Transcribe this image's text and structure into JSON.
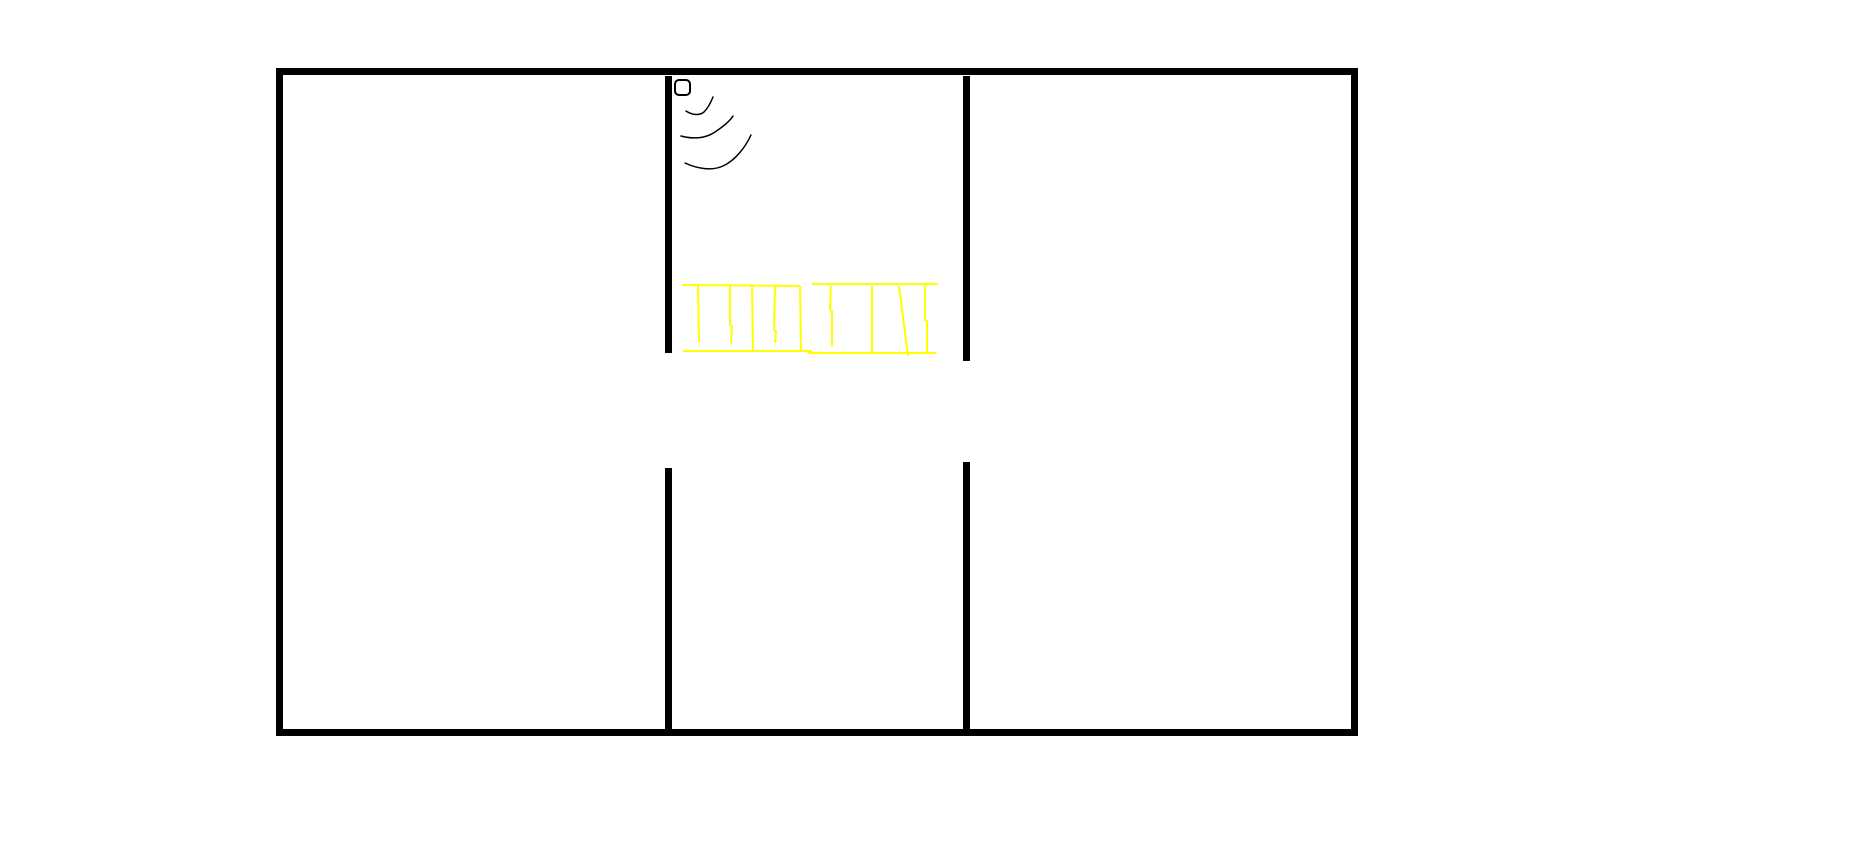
{
  "canvas": {
    "width": 1860,
    "height": 861,
    "background_color": "#ffffff"
  },
  "colors": {
    "wall": "#000000",
    "sketch_line": "#000000",
    "ladder": "#ffff00"
  },
  "floor_plan": {
    "outer_wall": {
      "x": 276,
      "y": 68,
      "width": 1082,
      "height": 668,
      "thickness": 7
    },
    "inner_walls": [
      {
        "name": "left-divider-upper",
        "x": 665,
        "y": 76,
        "width": 7,
        "height": 277
      },
      {
        "name": "left-divider-lower",
        "x": 665,
        "y": 468,
        "width": 7,
        "height": 261
      },
      {
        "name": "right-divider-upper",
        "x": 963,
        "y": 76,
        "width": 7,
        "height": 285
      },
      {
        "name": "right-divider-lower",
        "x": 963,
        "y": 462,
        "width": 7,
        "height": 267
      }
    ],
    "doorway_gaps": [
      {
        "name": "left-divider-doorway",
        "x": 665,
        "y_top": 353,
        "y_bottom": 468
      },
      {
        "name": "right-divider-doorway",
        "x": 963,
        "y_top": 361,
        "y_bottom": 462
      }
    ],
    "rooms": [
      {
        "name": "left-room"
      },
      {
        "name": "middle-room"
      },
      {
        "name": "right-room"
      }
    ]
  },
  "wifi_device": {
    "box": {
      "x": 675,
      "y": 80,
      "width": 15,
      "height": 15,
      "rx": 4,
      "stroke_width": 2
    },
    "waves": [
      {
        "name": "signal-wave-1",
        "path": "M 686 111 C 692 115 699 116 704 112 C 708 108 711 102 713 97"
      },
      {
        "name": "signal-wave-2",
        "path": "M 681 136 C 692 139 705 139 715 132 C 724 126 730 121 733 116"
      },
      {
        "name": "signal-wave-3",
        "path": "M 685 163 C 698 169 712 171 723 166 C 736 160 746 146 751 135"
      }
    ]
  },
  "ladder": {
    "stroke_width": 2,
    "rails": [
      {
        "name": "ladder-top-rail-left",
        "points": "682,285 800,286"
      },
      {
        "name": "ladder-top-rail-right",
        "points": "812,284 938,284"
      },
      {
        "name": "ladder-bottom-rail-left",
        "points": "683,351 812,351"
      },
      {
        "name": "ladder-bottom-rail-right",
        "points": "808,353 936,353"
      }
    ],
    "rungs": [
      {
        "name": "ladder-rung-1",
        "points": "698,286 699,343"
      },
      {
        "name": "ladder-rung-2",
        "points": "730,286 730,325 732,326 731,344"
      },
      {
        "name": "ladder-rung-3",
        "points": "752,286 753,352"
      },
      {
        "name": "ladder-rung-4",
        "points": "775,286 774,330 776,331 775,343"
      },
      {
        "name": "ladder-rung-5",
        "points": "800,286 801,352"
      },
      {
        "name": "ladder-rung-6",
        "points": "831,286 830,310 832,311 832,347"
      },
      {
        "name": "ladder-rung-7",
        "points": "872,286 872,352"
      },
      {
        "name": "ladder-rung-8",
        "points": "899,286 908,356"
      },
      {
        "name": "ladder-rung-9",
        "points": "925,285 925,320 927,321 927,352"
      }
    ]
  }
}
